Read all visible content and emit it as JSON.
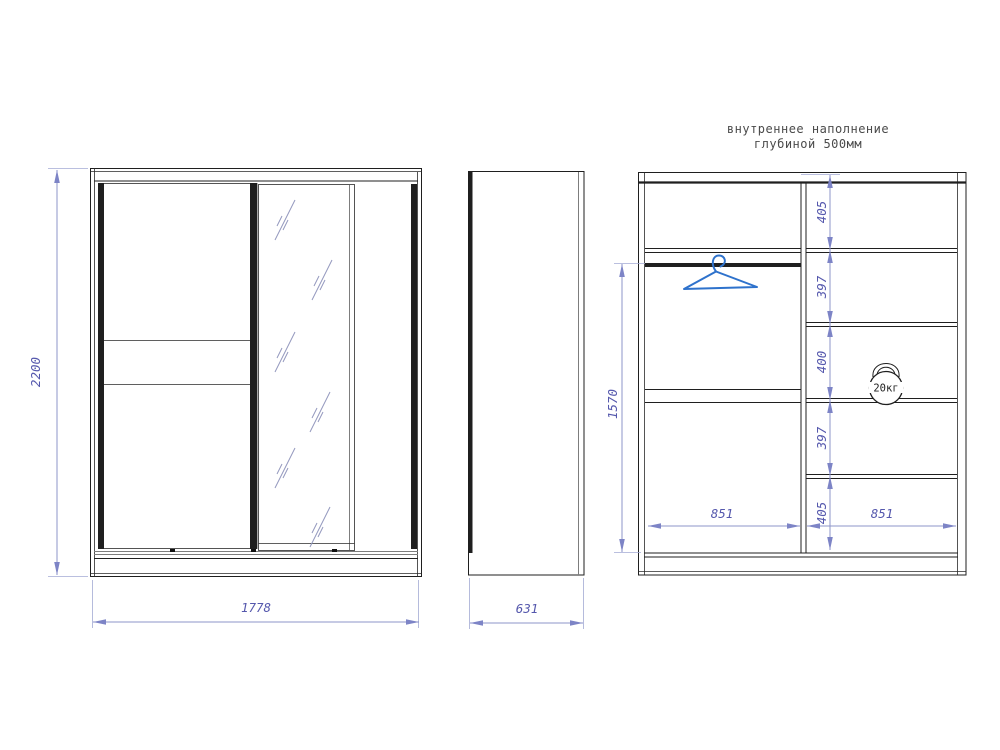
{
  "annotation": {
    "line1": "внутреннее наполнение",
    "line2": "глубиной 500мм"
  },
  "front_view": {
    "overall_height": "2200",
    "overall_width": "1778"
  },
  "side_view": {
    "overall_depth": "631"
  },
  "internal_view": {
    "hanging_section_height": "1570",
    "right_shelf_heights": [
      "405",
      "397",
      "400",
      "397",
      "405"
    ],
    "compartment_widths": [
      "851",
      "851"
    ],
    "max_load": "20кг"
  },
  "colors": {
    "outline": "#1f1f1f",
    "dimension_line": "#8d95c9",
    "dimension_text": "#5558ad",
    "hanger_blue": "#2e72cc",
    "mirror_hatch": "#9297bd",
    "annotation_text": "#4a4a4a"
  }
}
